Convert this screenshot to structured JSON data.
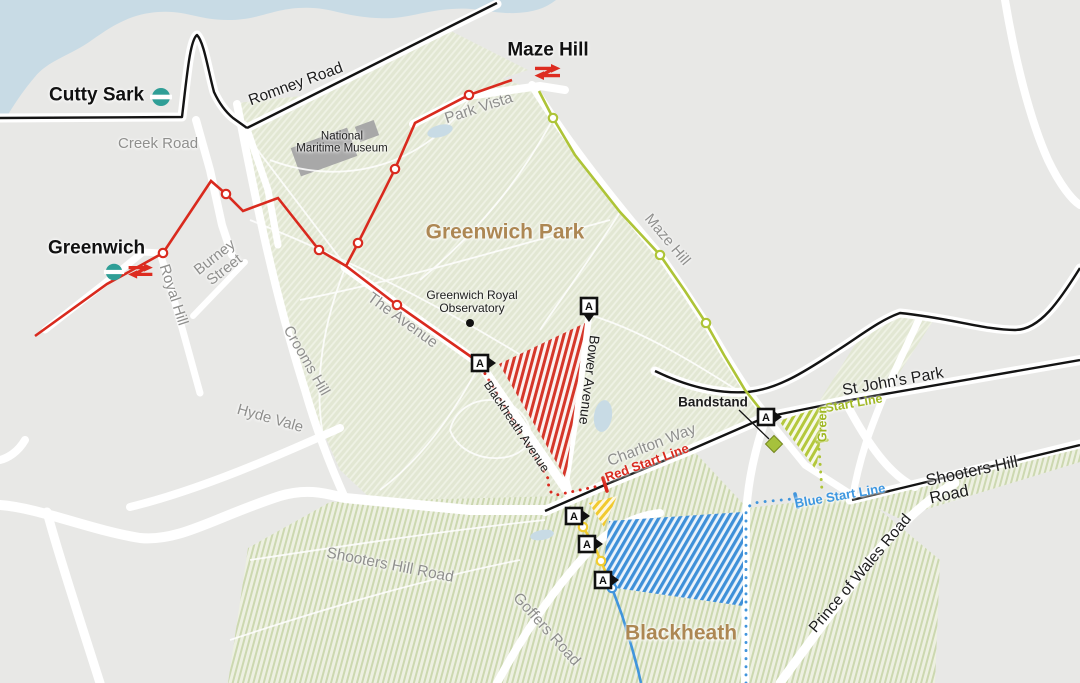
{
  "map": {
    "markers": {
      "letter": "A"
    },
    "stations": {
      "cutty_sark": {
        "name": "Cutty Sark"
      },
      "maze_hill": {
        "name": "Maze Hill"
      },
      "greenwich": {
        "name": "Greenwich"
      }
    },
    "areas": {
      "greenwich_park": "Greenwich Park",
      "blackheath": "Blackheath"
    },
    "roads": {
      "creek_road": "Creek Road",
      "romney_road": "Romney Road",
      "park_vista": "Park Vista",
      "maze_hill_road": "Maze Hill",
      "royal_hill": "Royal Hill",
      "burney_street": "Burney\nStreet",
      "crooms_hill": "Crooms Hill",
      "hyde_vale": "Hyde Vale",
      "the_avenue": "The Avenue",
      "blackheath_avenue": "Blackheath Avenue",
      "bower_avenue": "Bower Avenue",
      "charlton_way": "Charlton Way",
      "st_johns_park": "St John's Park",
      "shooters_hill_road_east": "Shooters Hill Road",
      "shooters_hill_road_west": "Shooters Hill Road",
      "prince_of_wales_road": "Prince of Wales Road",
      "goffers_road": "Goffers Road"
    },
    "pois": {
      "national_maritime_museum": "National\nMaritime Museum",
      "royal_observatory": "Greenwich Royal\nObservatory",
      "bandstand": "Bandstand"
    },
    "start_lines": {
      "red": "Red Start Line",
      "green_word": "Green",
      "green_rest": "Start Line",
      "blue": "Blue Start Line"
    },
    "colors": {
      "red_route": "#d92a1e",
      "green_route": "#aec437",
      "blue_route": "#4195dc",
      "yellow_route": "#f2cd30",
      "dlr_teal": "#2f9e96",
      "area_brown": "#ad8753",
      "water_blue": "#c8dbe5"
    }
  }
}
